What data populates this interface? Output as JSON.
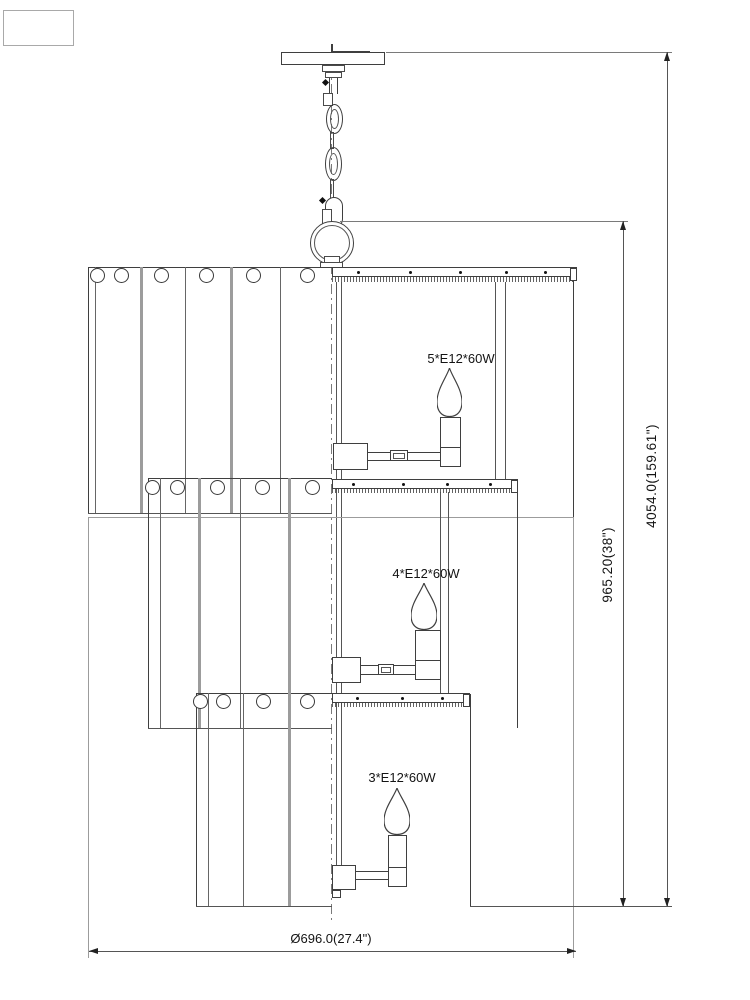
{
  "drawing": {
    "type": "chandelier installation dimension drawing",
    "bulb_labels": {
      "tier1": "5*E12*60W",
      "tier2": "4*E12*60W",
      "tier3": "3*E12*60W"
    },
    "dimensions": {
      "body_height": "965.20(38\")",
      "overall_height": "4054.0(159.61\")",
      "diameter": "Ø696.0(27.4\")"
    },
    "colors": {
      "line_dark": "#3f3f3f",
      "line_gray": "#9c9c9c",
      "dimension_line": "#555555",
      "text": "#141414",
      "background": "#ffffff"
    }
  },
  "geometry": {
    "tiers": [
      {
        "name": "tier1",
        "panel_x0": 88,
        "panel_x1": 332,
        "top": 267,
        "bottom": 513,
        "bar": {
          "x0": 332,
          "x1": 577,
          "y0": 267,
          "y1": 277,
          "hatch_h": 5,
          "cap_w": 7,
          "rivets": [
            358,
            410,
            460,
            506,
            545
          ],
          "rivet_y": 272
        },
        "dividers_thin": [
          95,
          185,
          280
        ],
        "dividers_thick": [
          140,
          230
        ],
        "holes": [
          97,
          121,
          161,
          206,
          253,
          307
        ],
        "hole_y": 275,
        "right_edge": {
          "x": 573,
          "y0": 268,
          "y1": 517
        },
        "rods": {
          "x": [
            495,
            505
          ],
          "y0": 282,
          "y1": 479
        },
        "candle": {
          "flame": {
            "x": 437,
            "y": 368,
            "w": 25,
            "h": 49
          },
          "socket": {
            "x": 440,
            "y": 417,
            "w": 21,
            "h": 50,
            "div_y": 447
          },
          "arm": {
            "x0": 368,
            "x1": 440,
            "y": 452,
            "h": 8
          },
          "clamp": {
            "x": 390,
            "y": 450,
            "w": 18,
            "h": 11
          },
          "block": {
            "x": 333,
            "y": 443,
            "w": 35,
            "h": 27
          }
        }
      },
      {
        "name": "tier2",
        "panel_x0": 148,
        "panel_x1": 332,
        "top": 478,
        "bottom": 728,
        "bar": {
          "x0": 332,
          "x1": 518,
          "y0": 479,
          "y1": 489,
          "hatch_h": 4,
          "cap_w": 7,
          "rivets": [
            353,
            403,
            447,
            490
          ],
          "rivet_y": 484
        },
        "dividers_thin": [
          160,
          240
        ],
        "dividers_thick": [
          198,
          288
        ],
        "holes": [
          152,
          177,
          217,
          262,
          312
        ],
        "hole_y": 487,
        "right_edge": {
          "x": 517,
          "y0": 480,
          "y1": 728
        },
        "rods": {
          "x": [
            440,
            448
          ],
          "y0": 492,
          "y1": 694
        },
        "candle": {
          "flame": {
            "x": 411,
            "y": 583,
            "w": 26,
            "h": 47
          },
          "socket": {
            "x": 415,
            "y": 630,
            "w": 26,
            "h": 50,
            "div_y": 660
          },
          "arm": {
            "x0": 361,
            "x1": 415,
            "y": 665,
            "h": 9
          },
          "clamp": {
            "x": 378,
            "y": 664,
            "w": 16,
            "h": 11
          },
          "block": {
            "x": 332,
            "y": 657,
            "w": 29,
            "h": 26
          }
        }
      },
      {
        "name": "tier3",
        "panel_x0": 196,
        "panel_x1": 332,
        "top": 693,
        "bottom": 906,
        "bar": {
          "x0": 332,
          "x1": 470,
          "y0": 693,
          "y1": 703,
          "hatch_h": 4,
          "cap_w": 7,
          "rivets": [
            357,
            402,
            442
          ],
          "rivet_y": 698
        },
        "dividers_thin": [
          208,
          243
        ],
        "dividers_thick": [
          288
        ],
        "holes": [
          200,
          223,
          263,
          307
        ],
        "hole_y": 701,
        "right_edge": {
          "x": 470,
          "y0": 694,
          "y1": 906
        },
        "rods": null,
        "candle": {
          "flame": {
            "x": 384,
            "y": 788,
            "w": 26,
            "h": 47
          },
          "socket": {
            "x": 388,
            "y": 835,
            "w": 19,
            "h": 52,
            "div_y": 867
          },
          "arm": {
            "x0": 356,
            "x1": 388,
            "y": 871,
            "h": 8
          },
          "clamp": null,
          "block": {
            "x": 332,
            "y": 865,
            "w": 24,
            "h": 25
          },
          "notch": {
            "x": 332,
            "y": 890,
            "w": 9,
            "h": 8
          }
        }
      }
    ],
    "hole_r": 7.5
  }
}
